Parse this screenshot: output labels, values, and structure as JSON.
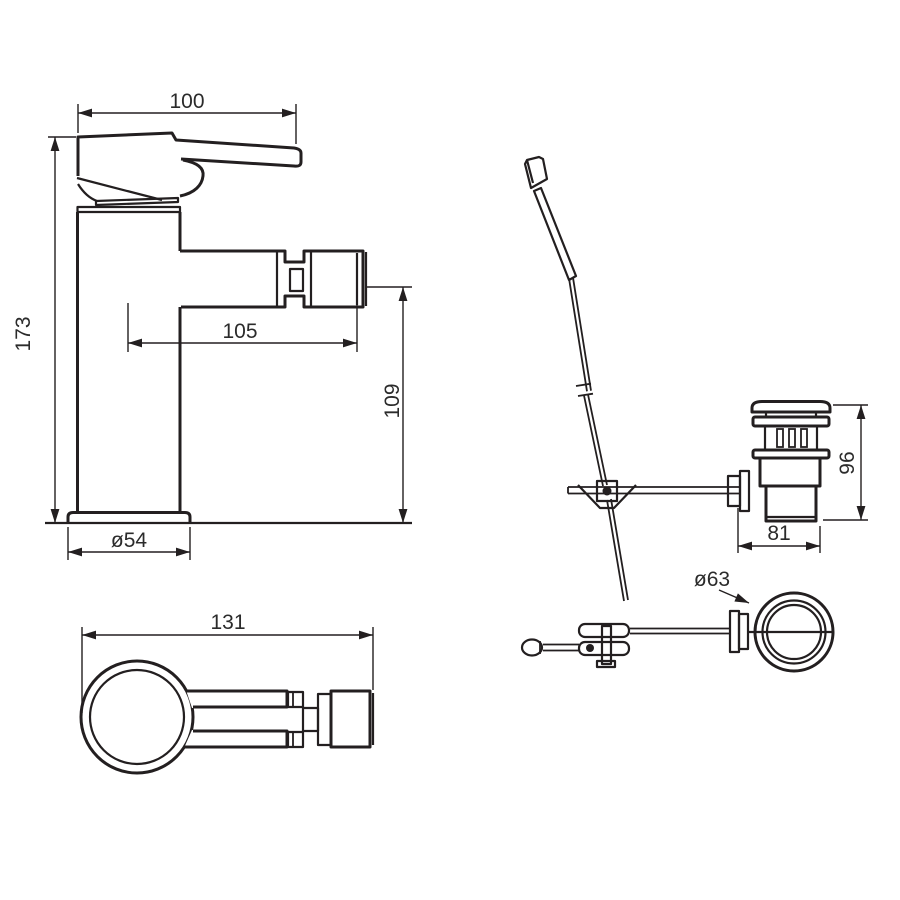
{
  "drawing": {
    "front": {
      "dim_handle_width": "100",
      "dim_total_height": "173",
      "dim_spout_reach": "105",
      "dim_outlet_height": "109",
      "dim_base_diameter": "ø54"
    },
    "plan": {
      "dim_overall_length": "131"
    },
    "waste_side": {
      "dim_height": "96",
      "dim_width": "81"
    },
    "waste_plan": {
      "dim_flange_diameter": "ø63"
    },
    "colors": {
      "line": "#231f20",
      "text": "#2b2b2b",
      "background": "#ffffff"
    }
  }
}
